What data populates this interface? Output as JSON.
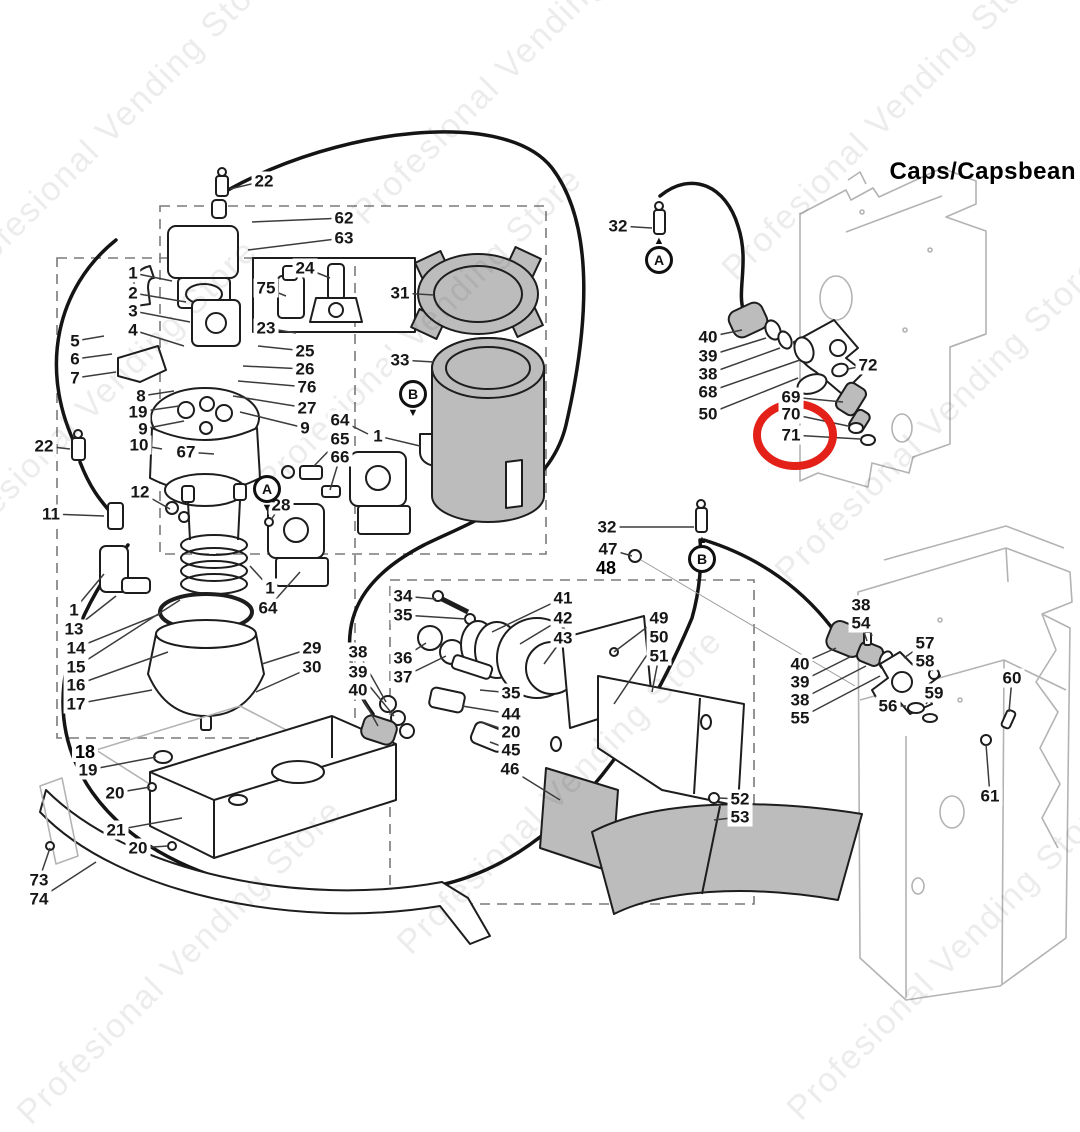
{
  "title": "Caps/Capsbean",
  "watermark": {
    "text": "Profesional Vending Store",
    "positions": [
      [
        115,
        125
      ],
      [
        515,
        62
      ],
      [
        885,
        118
      ],
      [
        95,
        402
      ],
      [
        420,
        330
      ],
      [
        938,
        420
      ],
      [
        560,
        792
      ],
      [
        180,
        962
      ],
      [
        950,
        958
      ]
    ]
  },
  "colors": {
    "line": "#1d1d1d",
    "gray_fill": "#bcbcbc",
    "cabinet": "#b3b3b3",
    "highlight": "#e32119"
  },
  "highlight": {
    "part": "71",
    "color": "#e32119"
  },
  "markers": [
    {
      "letter": "A",
      "x": 659,
      "y": 260,
      "arrow": "above"
    },
    {
      "letter": "B",
      "x": 702,
      "y": 559,
      "arrow": "above"
    },
    {
      "letter": "A",
      "x": 267,
      "y": 489,
      "arrow": "below"
    },
    {
      "letter": "B",
      "x": 413,
      "y": 394,
      "arrow": "below"
    }
  ],
  "labels": [
    {
      "t": "22",
      "x": 264,
      "y": 181,
      "lx": 230,
      "ly": 189
    },
    {
      "t": "62",
      "x": 344,
      "y": 218,
      "lx": 252,
      "ly": 222
    },
    {
      "t": "63",
      "x": 344,
      "y": 238,
      "lx": 248,
      "ly": 250
    },
    {
      "t": "24",
      "x": 305,
      "y": 268,
      "lx": 330,
      "ly": 278
    },
    {
      "t": "75",
      "x": 266,
      "y": 288,
      "lx": 286,
      "ly": 296
    },
    {
      "t": "23",
      "x": 266,
      "y": 328,
      "lx": 296,
      "ly": 333
    },
    {
      "t": "25",
      "x": 305,
      "y": 351,
      "lx": 258,
      "ly": 346
    },
    {
      "t": "26",
      "x": 305,
      "y": 369,
      "lx": 243,
      "ly": 366
    },
    {
      "t": "76",
      "x": 307,
      "y": 387,
      "lx": 238,
      "ly": 381
    },
    {
      "t": "27",
      "x": 307,
      "y": 408,
      "lx": 233,
      "ly": 396
    },
    {
      "t": "9",
      "x": 305,
      "y": 428,
      "lx": 240,
      "ly": 412
    },
    {
      "t": "1",
      "x": 133,
      "y": 273,
      "lx": 172,
      "ly": 281
    },
    {
      "t": "2",
      "x": 133,
      "y": 293,
      "lx": 186,
      "ly": 302
    },
    {
      "t": "3",
      "x": 133,
      "y": 311,
      "lx": 190,
      "ly": 322
    },
    {
      "t": "4",
      "x": 133,
      "y": 330,
      "lx": 184,
      "ly": 346
    },
    {
      "t": "5",
      "x": 75,
      "y": 341,
      "lx": 104,
      "ly": 336
    },
    {
      "t": "6",
      "x": 75,
      "y": 359,
      "lx": 112,
      "ly": 354
    },
    {
      "t": "7",
      "x": 75,
      "y": 378,
      "lx": 116,
      "ly": 372
    },
    {
      "t": "8",
      "x": 141,
      "y": 396,
      "lx": 174,
      "ly": 391
    },
    {
      "t": "19",
      "x": 138,
      "y": 412,
      "lx": 179,
      "ly": 406
    },
    {
      "t": "9",
      "x": 143,
      "y": 429,
      "lx": 184,
      "ly": 421
    },
    {
      "t": "31",
      "x": 400,
      "y": 293,
      "lx": 434,
      "ly": 295
    },
    {
      "t": "33",
      "x": 400,
      "y": 360,
      "lx": 434,
      "ly": 362
    },
    {
      "t": "64",
      "x": 340,
      "y": 420,
      "lx": 368,
      "ly": 434
    },
    {
      "t": "65",
      "x": 340,
      "y": 439,
      "lx": 314,
      "ly": 466
    },
    {
      "t": "66",
      "x": 340,
      "y": 457,
      "lx": 330,
      "ly": 490
    },
    {
      "t": "1",
      "x": 378,
      "y": 436,
      "lx": 420,
      "ly": 446
    },
    {
      "t": "28",
      "x": 281,
      "y": 505,
      "lx": 271,
      "ly": 520
    },
    {
      "t": "10",
      "x": 139,
      "y": 445,
      "lx": 162,
      "ly": 449
    },
    {
      "t": "67",
      "x": 186,
      "y": 452,
      "lx": 214,
      "ly": 454
    },
    {
      "t": "22",
      "x": 44,
      "y": 446,
      "lx": 70,
      "ly": 449
    },
    {
      "t": "11",
      "x": 51,
      "y": 514,
      "lx": 104,
      "ly": 516
    },
    {
      "t": "12",
      "x": 140,
      "y": 492,
      "lx": 170,
      "ly": 509
    },
    {
      "t": "1",
      "x": 74,
      "y": 610,
      "lx": 104,
      "ly": 574
    },
    {
      "t": "13",
      "x": 74,
      "y": 629,
      "lx": 116,
      "ly": 596
    },
    {
      "t": "14",
      "x": 76,
      "y": 648,
      "lx": 160,
      "ly": 614
    },
    {
      "t": "15",
      "x": 76,
      "y": 667,
      "lx": 180,
      "ly": 600
    },
    {
      "t": "16",
      "x": 76,
      "y": 685,
      "lx": 168,
      "ly": 652
    },
    {
      "t": "17",
      "x": 76,
      "y": 704,
      "lx": 152,
      "ly": 690
    },
    {
      "t": "1",
      "x": 270,
      "y": 588,
      "lx": 250,
      "ly": 566
    },
    {
      "t": "64",
      "x": 268,
      "y": 608,
      "lx": 300,
      "ly": 572
    },
    {
      "t": "29",
      "x": 312,
      "y": 648,
      "lx": 262,
      "ly": 664
    },
    {
      "t": "30",
      "x": 312,
      "y": 667,
      "lx": 256,
      "ly": 692
    },
    {
      "t": "18",
      "x": 85,
      "y": 752,
      "bold": true
    },
    {
      "t": "19",
      "x": 88,
      "y": 770,
      "lx": 156,
      "ly": 757
    },
    {
      "t": "20",
      "x": 115,
      "y": 793,
      "lx": 150,
      "ly": 787
    },
    {
      "t": "21",
      "x": 116,
      "y": 830,
      "lx": 182,
      "ly": 818
    },
    {
      "t": "20",
      "x": 138,
      "y": 848,
      "lx": 168,
      "ly": 846
    },
    {
      "t": "73",
      "x": 39,
      "y": 880,
      "lx": 50,
      "ly": 848
    },
    {
      "t": "74",
      "x": 39,
      "y": 899,
      "lx": 96,
      "ly": 862
    },
    {
      "t": "32",
      "x": 607,
      "y": 527,
      "lx": 694,
      "ly": 527
    },
    {
      "t": "47",
      "x": 608,
      "y": 549,
      "lx": 632,
      "ly": 556
    },
    {
      "t": "48",
      "x": 606,
      "y": 568,
      "bold": true
    },
    {
      "t": "34",
      "x": 403,
      "y": 596,
      "lx": 436,
      "ly": 599
    },
    {
      "t": "35",
      "x": 403,
      "y": 615,
      "lx": 466,
      "ly": 619
    },
    {
      "t": "36",
      "x": 403,
      "y": 658,
      "lx": 426,
      "ly": 643
    },
    {
      "t": "37",
      "x": 403,
      "y": 677,
      "lx": 446,
      "ly": 656
    },
    {
      "t": "38",
      "x": 358,
      "y": 652,
      "lx": 386,
      "ly": 702
    },
    {
      "t": "39",
      "x": 358,
      "y": 672,
      "lx": 394,
      "ly": 716
    },
    {
      "t": "40",
      "x": 358,
      "y": 690,
      "lx": 378,
      "ly": 726
    },
    {
      "t": "41",
      "x": 563,
      "y": 598,
      "lx": 492,
      "ly": 632
    },
    {
      "t": "42",
      "x": 563,
      "y": 618,
      "lx": 520,
      "ly": 644
    },
    {
      "t": "43",
      "x": 563,
      "y": 638,
      "lx": 544,
      "ly": 664
    },
    {
      "t": "35",
      "x": 511,
      "y": 693,
      "lx": 480,
      "ly": 690
    },
    {
      "t": "44",
      "x": 511,
      "y": 714,
      "lx": 462,
      "ly": 706
    },
    {
      "t": "20",
      "x": 511,
      "y": 732,
      "lx": 482,
      "ly": 722
    },
    {
      "t": "45",
      "x": 511,
      "y": 750,
      "lx": 490,
      "ly": 742
    },
    {
      "t": "46",
      "x": 510,
      "y": 769,
      "lx": 560,
      "ly": 800
    },
    {
      "t": "49",
      "x": 659,
      "y": 618,
      "lx": 614,
      "ly": 652
    },
    {
      "t": "50",
      "x": 659,
      "y": 637,
      "lx": 614,
      "ly": 704
    },
    {
      "t": "51",
      "x": 659,
      "y": 656,
      "lx": 652,
      "ly": 692
    },
    {
      "t": "52",
      "x": 740,
      "y": 799,
      "lx": 718,
      "ly": 798
    },
    {
      "t": "53",
      "x": 740,
      "y": 817,
      "lx": 714,
      "ly": 820
    },
    {
      "t": "32",
      "x": 618,
      "y": 226,
      "lx": 652,
      "ly": 228
    },
    {
      "t": "40",
      "x": 708,
      "y": 337,
      "lx": 742,
      "ly": 330
    },
    {
      "t": "39",
      "x": 708,
      "y": 356,
      "lx": 766,
      "ly": 338
    },
    {
      "t": "38",
      "x": 708,
      "y": 374,
      "lx": 780,
      "ly": 348
    },
    {
      "t": "68",
      "x": 708,
      "y": 392,
      "lx": 800,
      "ly": 360
    },
    {
      "t": "50",
      "x": 708,
      "y": 414,
      "lx": 798,
      "ly": 378
    },
    {
      "t": "69",
      "x": 791,
      "y": 397,
      "lx": 843,
      "ly": 402
    },
    {
      "t": "70",
      "x": 791,
      "y": 414,
      "lx": 848,
      "ly": 426
    },
    {
      "t": "71",
      "x": 791,
      "y": 435,
      "lx": 860,
      "ly": 439,
      "hl": true
    },
    {
      "t": "72",
      "x": 868,
      "y": 365,
      "lx": 848,
      "ly": 369
    },
    {
      "t": "38",
      "x": 861,
      "y": 605,
      "lx": 872,
      "ly": 636
    },
    {
      "t": "54",
      "x": 861,
      "y": 623,
      "lx": 867,
      "ly": 641
    },
    {
      "t": "40",
      "x": 800,
      "y": 664,
      "lx": 836,
      "ly": 648
    },
    {
      "t": "39",
      "x": 800,
      "y": 682,
      "lx": 852,
      "ly": 656
    },
    {
      "t": "38",
      "x": 800,
      "y": 700,
      "lx": 866,
      "ly": 666
    },
    {
      "t": "55",
      "x": 800,
      "y": 718,
      "lx": 880,
      "ly": 676
    },
    {
      "t": "57",
      "x": 925,
      "y": 643,
      "lx": 904,
      "ly": 658
    },
    {
      "t": "58",
      "x": 925,
      "y": 661,
      "lx": 933,
      "ly": 671
    },
    {
      "t": "59",
      "x": 934,
      "y": 693,
      "lx": 926,
      "ly": 704
    },
    {
      "t": "56",
      "x": 888,
      "y": 706,
      "lx": 906,
      "ly": 706
    },
    {
      "t": "60",
      "x": 1012,
      "y": 678,
      "lx": 1009,
      "ly": 712
    },
    {
      "t": "61",
      "x": 990,
      "y": 796,
      "lx": 986,
      "ly": 744
    }
  ]
}
